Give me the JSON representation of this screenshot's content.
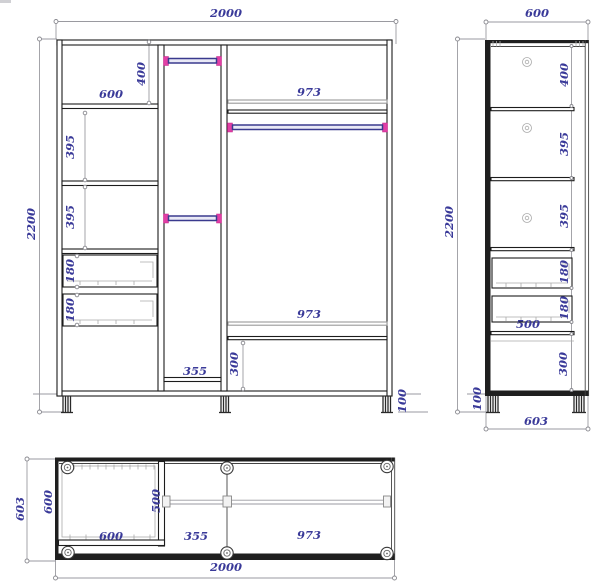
{
  "front_view": {
    "overall_width": "2000",
    "overall_height": "2200",
    "top_compartment_width": "600",
    "top_compartment_height": "400",
    "shelf_section_1": "395",
    "shelf_section_2": "395",
    "drawer_1_height": "180",
    "drawer_2_height": "180",
    "middle_column_width": "355",
    "right_shelf_top": "973",
    "right_shelf_bottom": "973",
    "bottom_compartment_height": "300",
    "leg_height": "100"
  },
  "side_view": {
    "overall_depth": "600",
    "overall_height": "2200",
    "section_1_height": "400",
    "section_2_height": "395",
    "section_3_height": "395",
    "drawer_1_height": "180",
    "drawer_2_height": "180",
    "drawer_depth": "500",
    "bottom_compartment_height": "300",
    "leg_height": "100",
    "base_depth": "603"
  },
  "top_view": {
    "overall_depth": "603",
    "left_section_depth": "600",
    "left_section_width": "600",
    "rod_span": "500",
    "middle_section_width": "355",
    "right_section_width": "973",
    "overall_width": "2000"
  },
  "colors": {
    "line": "#1c1c1c",
    "dim_line": "#9a9aa0",
    "label": "#3a3a99",
    "rod": "#3a3a8e",
    "rod_end": "#e23fa5"
  }
}
